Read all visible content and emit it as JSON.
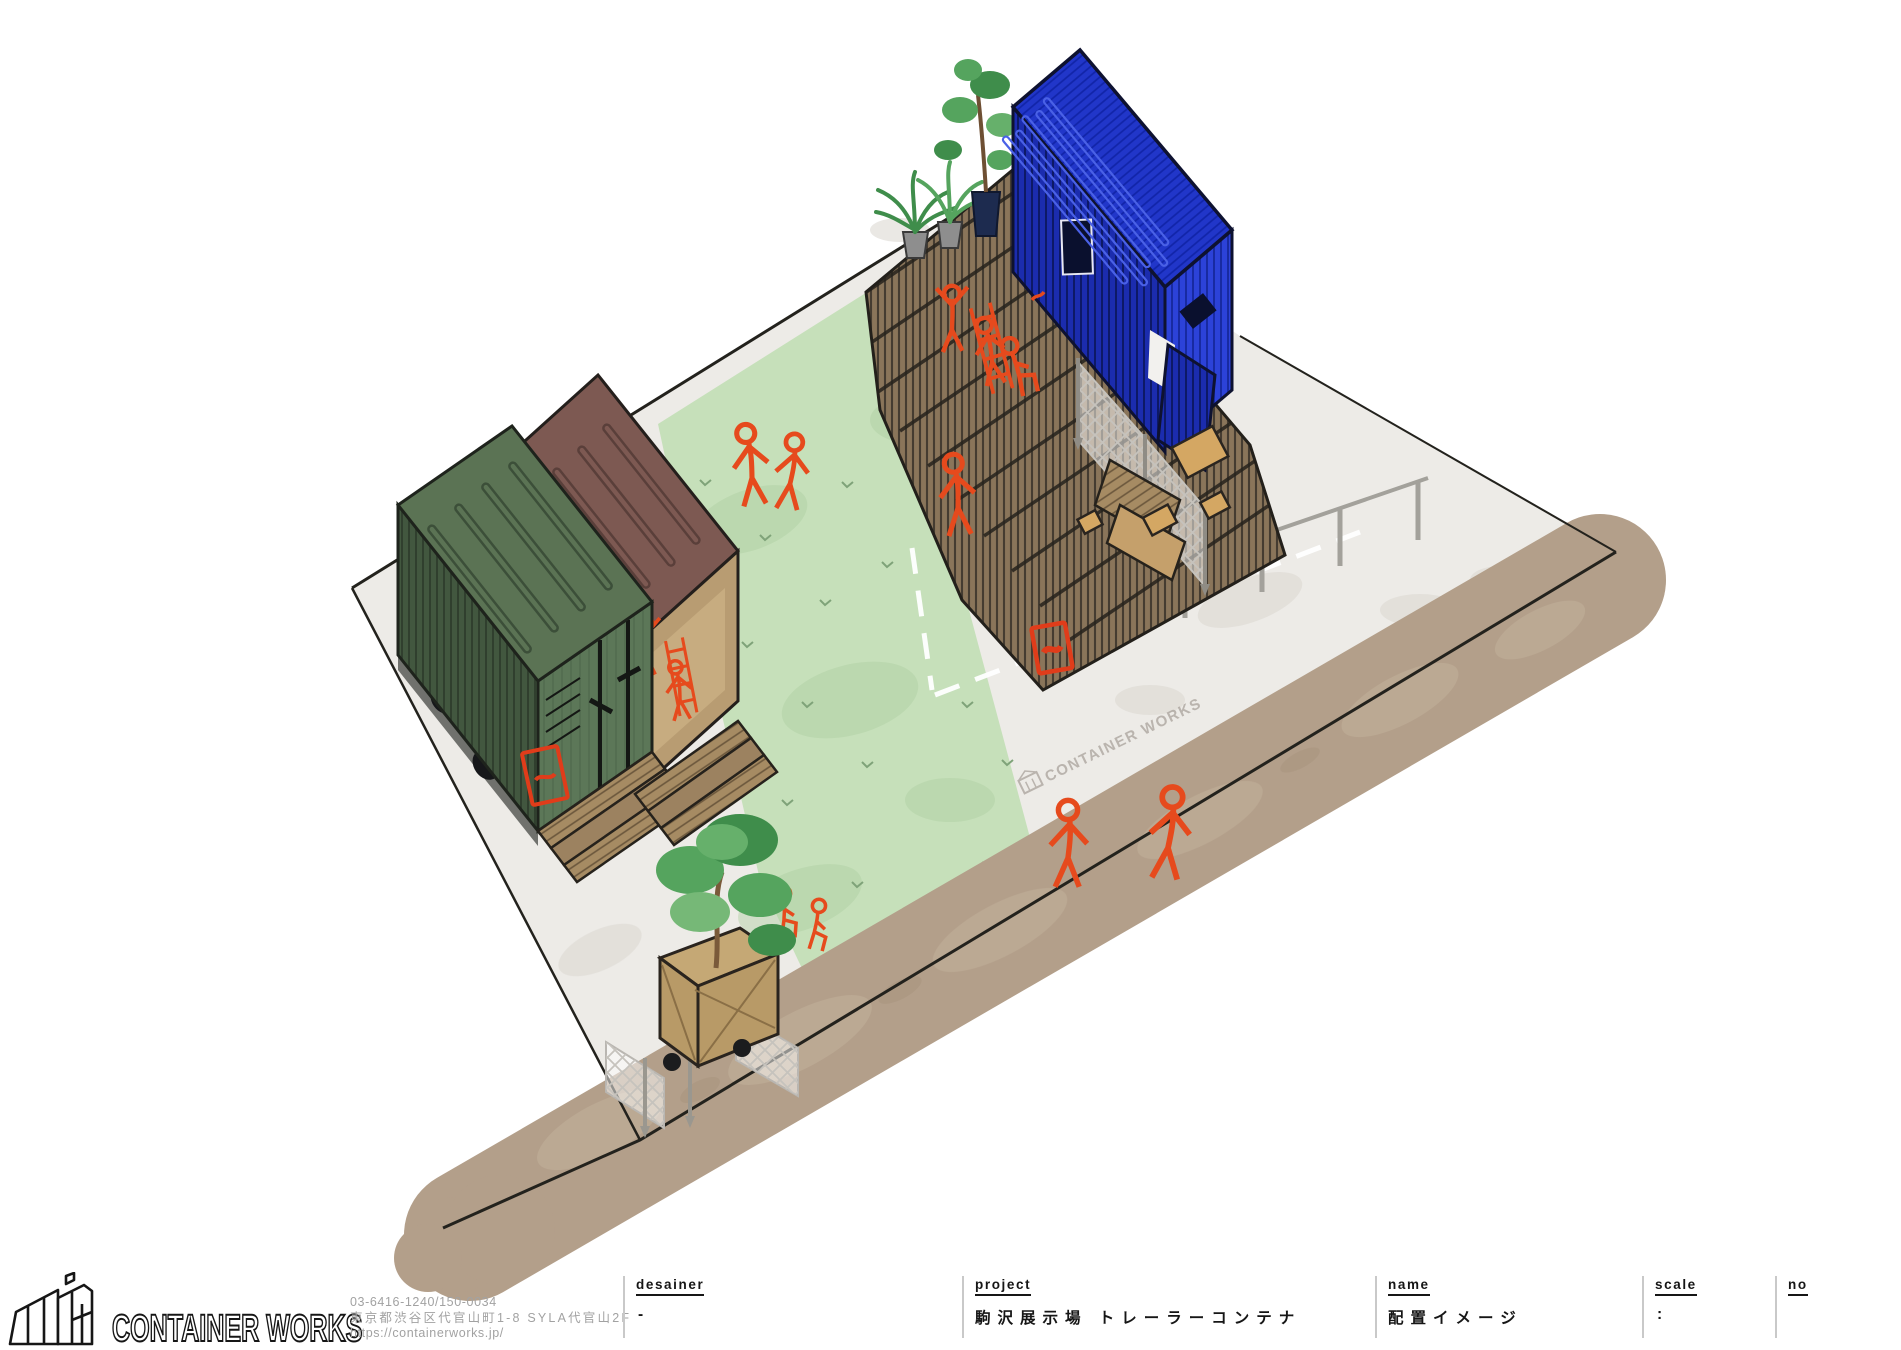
{
  "brand": {
    "name": "CONTAINER WORKS"
  },
  "contact": {
    "phone_postal": "03-6416-1240/150-0034",
    "address": "東京都渋谷区代官山町1-8 SYLA代官山2F",
    "url": "https://containerworks.jp/"
  },
  "title_block": {
    "desainer": {
      "label": "desainer",
      "value": "-"
    },
    "project": {
      "label": "project",
      "value": "駒沢展示場 トレーラーコンテナ"
    },
    "name": {
      "label": "name",
      "value": "配置イメージ"
    },
    "scale": {
      "label": "scale",
      "value": ":"
    },
    "no": {
      "label": "no",
      "value": ""
    }
  },
  "watermark": {
    "text": "CONTAINER WORKS"
  },
  "illustration": {
    "description": "Hand-drawn isometric site layout sketch: green and brown trailer containers with wooden step decks at left, large tiered wood deck with blue container, potted plants, lattice fence, parking markings, lawn strip, planter cart and dirt path, with orange sketched people",
    "colors": {
      "site_concrete": "#edebe7",
      "lawn_green": "#c6e0ba",
      "path_brown": "#b39f8a",
      "deck_wood": "#8a755a",
      "porch_wood": "#a68b63",
      "container_green": "#42573f",
      "container_brown": "#7d5952",
      "container_blue": "#2136c9",
      "sketch_orange": "#e64a1d",
      "sign_red": "#e03c1a"
    }
  }
}
